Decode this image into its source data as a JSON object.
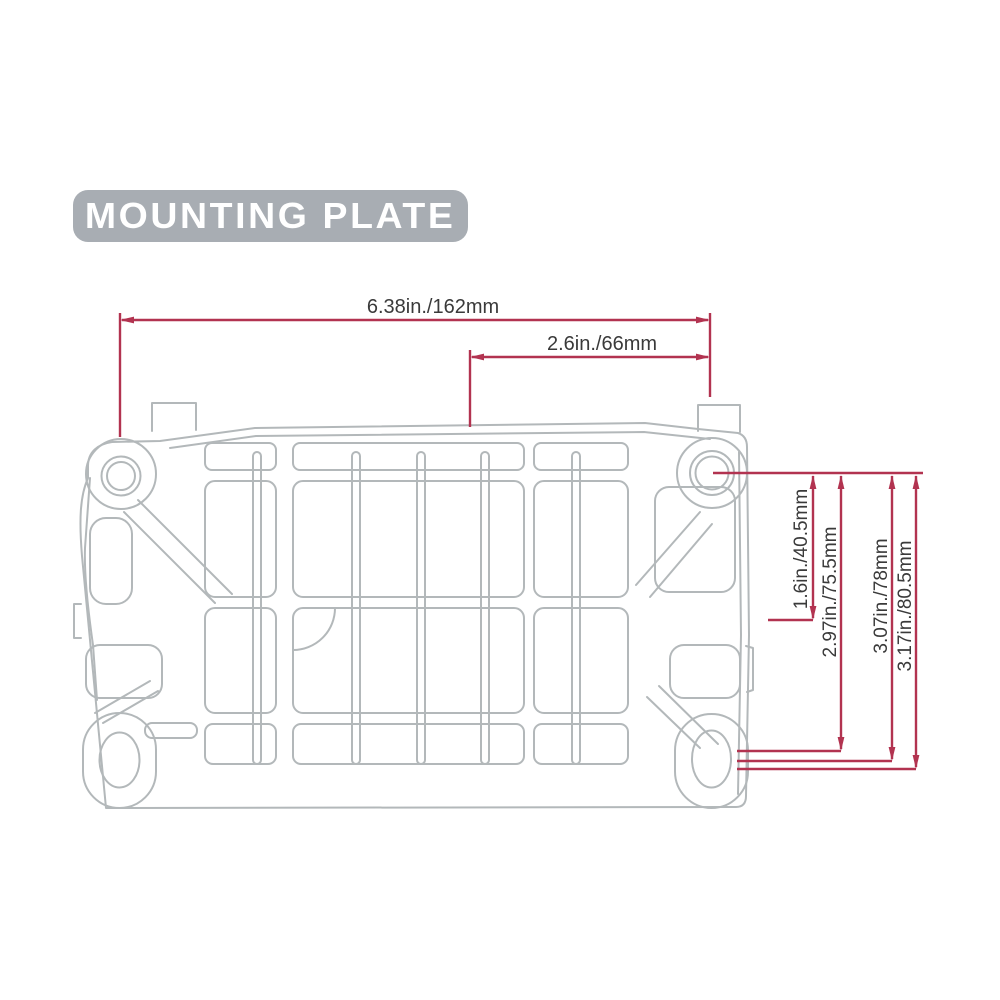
{
  "title": {
    "label": "MOUNTING PLATE"
  },
  "diagram": {
    "subject": "mounting-plate-top-view",
    "dimensions": {
      "horizontal": [
        {
          "id": "overall-width",
          "label": "6.38in./162mm"
        },
        {
          "id": "hole-offset-width",
          "label": "2.6in./66mm"
        }
      ],
      "vertical": [
        {
          "id": "hole-to-slot-top",
          "label": "1.6in./40.5mm"
        },
        {
          "id": "hole-span-1",
          "label": "2.97in./75.5mm"
        },
        {
          "id": "hole-span-2",
          "label": "3.07in./78mm"
        },
        {
          "id": "hole-span-3",
          "label": "3.17in./80.5mm"
        }
      ]
    },
    "colors": {
      "dimension_line": "#b23350",
      "plate_outline": "#b3b8ba",
      "label_text": "#3a3a3a",
      "title_background": "#a8adb3",
      "title_text": "#ffffff"
    }
  }
}
